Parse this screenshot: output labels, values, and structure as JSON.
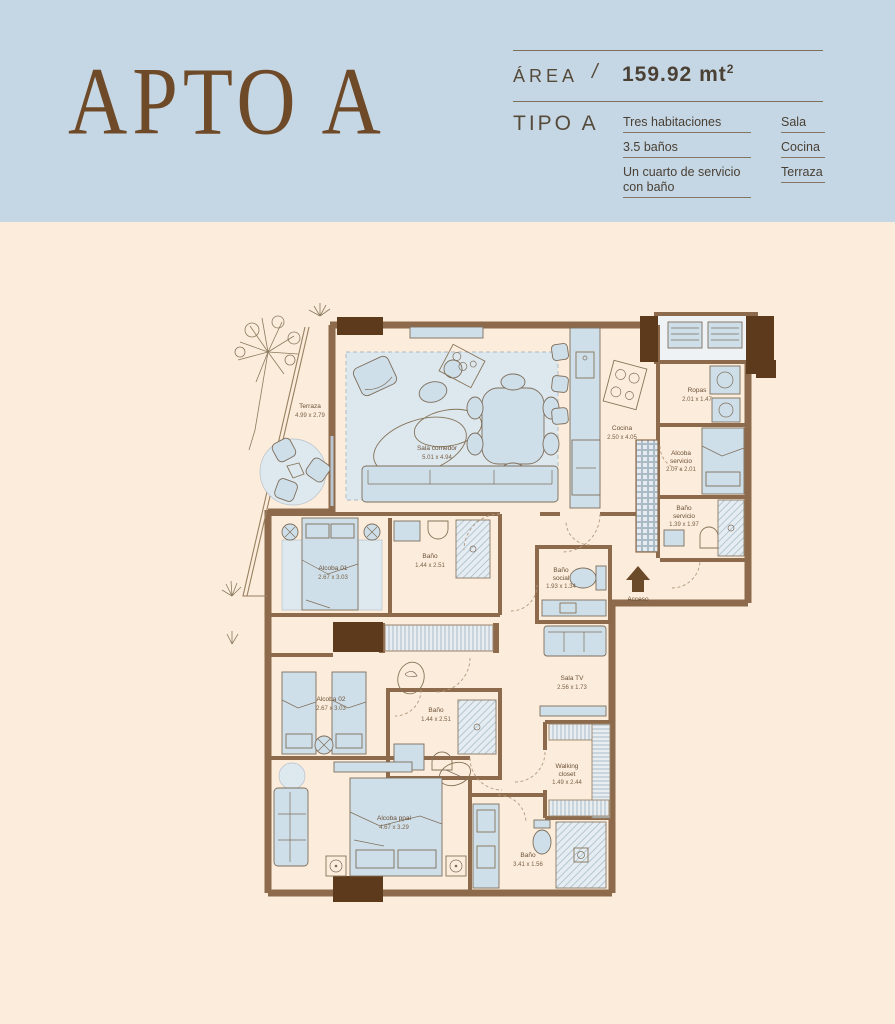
{
  "header": {
    "title": "APTO A",
    "area_label": "ÁREA",
    "separator": "/",
    "area_value": "159.92 mt",
    "area_sup": "2",
    "tipo_label": "TIPO A",
    "features": [
      "Tres habitaciones",
      "3.5 baños",
      "Un cuarto de servicio con baño"
    ],
    "amenities": [
      "Sala",
      "Cocina",
      "Terraza"
    ]
  },
  "plan": {
    "access_label": "Acceso",
    "rooms": [
      {
        "id": "terraza",
        "lines": [
          "Terraza",
          "4.99 x 2.79"
        ]
      },
      {
        "id": "sala-comedor",
        "lines": [
          "Sala comedor",
          "5.01 x 4.94"
        ]
      },
      {
        "id": "cocina",
        "lines": [
          "Cocina",
          "2.50 x 4.05"
        ]
      },
      {
        "id": "ropas",
        "lines": [
          "Ropas",
          "2.01 x 1.47"
        ]
      },
      {
        "id": "alcoba-servicio",
        "lines": [
          "Alcoba",
          "servicio",
          "2.07 x 2.01"
        ]
      },
      {
        "id": "bano-servicio",
        "lines": [
          "Baño",
          "servicio",
          "1.39 x 1.97"
        ]
      },
      {
        "id": "bano-social",
        "lines": [
          "Baño",
          "social",
          "1.93 x 1.34"
        ]
      },
      {
        "id": "alcoba-01",
        "lines": [
          "Alcoba 01",
          "2.67 x 3.03"
        ]
      },
      {
        "id": "bano-01",
        "lines": [
          "Baño",
          "1.44 x 2.51"
        ]
      },
      {
        "id": "alcoba-02",
        "lines": [
          "Alcoba 02",
          "2.67 x 3.03"
        ]
      },
      {
        "id": "bano-02",
        "lines": [
          "Baño",
          "1.44 x 2.51"
        ]
      },
      {
        "id": "sala-tv",
        "lines": [
          "Sala TV",
          "2.56 x 1.73"
        ]
      },
      {
        "id": "walking-closet",
        "lines": [
          "Walking",
          "closet",
          "1.49 x 2.44"
        ]
      },
      {
        "id": "alcoba-ppal",
        "lines": [
          "Alcoba ppal",
          "4.67 x 3.29"
        ]
      },
      {
        "id": "bano-ppal",
        "lines": [
          "Baño",
          "3.41 x 1.56"
        ]
      }
    ]
  },
  "colors": {
    "header_bg": "#c5d7e5",
    "page_bg": "#fcecdb",
    "title_brown": "#6f4a28",
    "wall_brown": "#8d6a4b",
    "column_dark": "#5e3a1d",
    "furniture_blue": "#cfdfe9",
    "label_brown": "#6a5138"
  }
}
